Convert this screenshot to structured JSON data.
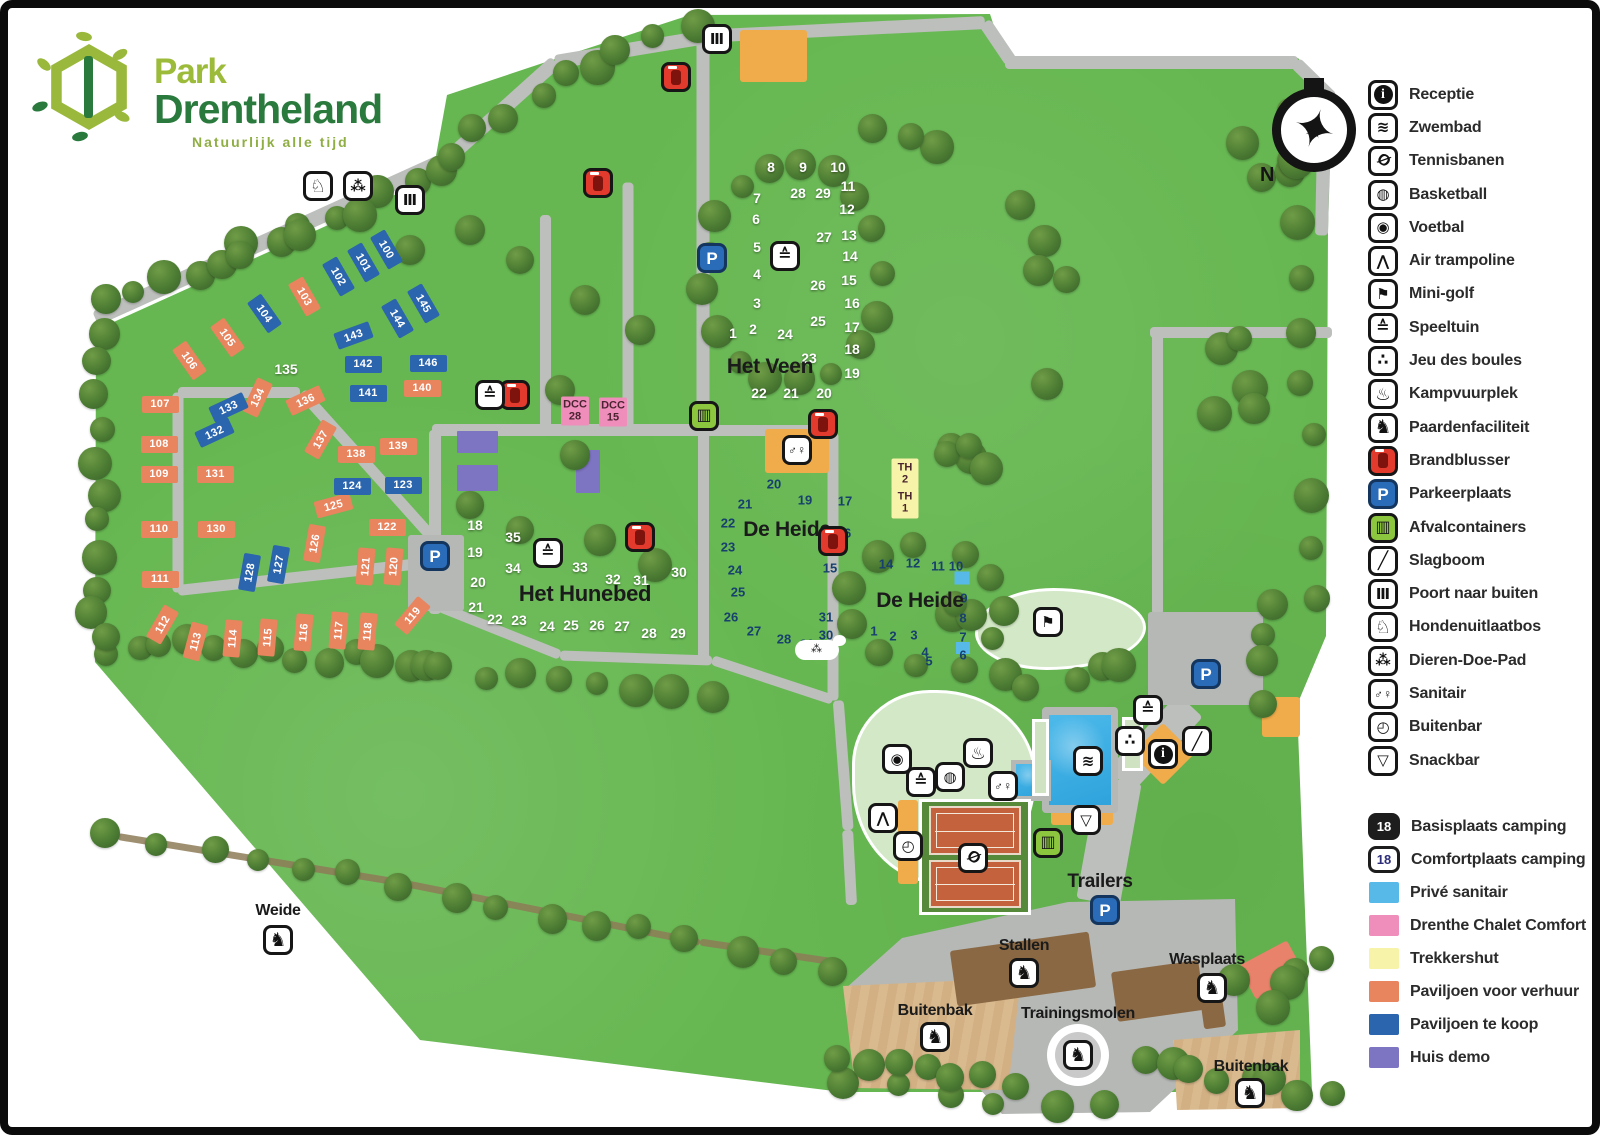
{
  "logo": {
    "line1": "Park",
    "line2": "Drentheland",
    "tagline": "Natuurlijk alle tijd"
  },
  "compass": {
    "north_label": "N"
  },
  "legend": {
    "facilities": [
      {
        "icon": "receptie",
        "label": "Receptie"
      },
      {
        "icon": "zwembad",
        "label": "Zwembad"
      },
      {
        "icon": "tennisbanen",
        "label": "Tennisbanen"
      },
      {
        "icon": "basketball",
        "label": "Basketball"
      },
      {
        "icon": "voetbal",
        "label": "Voetbal"
      },
      {
        "icon": "airtramp",
        "label": "Air trampoline"
      },
      {
        "icon": "minigolf",
        "label": "Mini-golf"
      },
      {
        "icon": "speeltuin",
        "label": "Speeltuin"
      },
      {
        "icon": "boules",
        "label": "Jeu des boules"
      },
      {
        "icon": "kampvuur",
        "label": "Kampvuurplek"
      },
      {
        "icon": "paard",
        "label": "Paardenfaciliteit"
      },
      {
        "icon": "fire",
        "label": "Brandblusser"
      },
      {
        "icon": "parking",
        "label": "Parkeerplaats"
      },
      {
        "icon": "trash",
        "label": "Afvalcontainers"
      },
      {
        "icon": "slagboom",
        "label": "Slagboom"
      },
      {
        "icon": "poort",
        "label": "Poort naar buiten"
      },
      {
        "icon": "hond",
        "label": "Hondenuitlaatbos"
      },
      {
        "icon": "paw",
        "label": "Dieren-Doe-Pad"
      },
      {
        "icon": "sanitair",
        "label": "Sanitair"
      },
      {
        "icon": "buitenbar",
        "label": "Buitenbar"
      },
      {
        "icon": "snackbar",
        "label": "Snackbar"
      }
    ],
    "categories": [
      {
        "type": "badge-dark",
        "badge": "18",
        "label": "Basisplaats camping"
      },
      {
        "type": "badge-outline",
        "badge": "18",
        "label": "Comfortplaats camping"
      },
      {
        "type": "swatch",
        "color": "#56b9e8",
        "label": "Privé sanitair"
      },
      {
        "type": "swatch",
        "color": "#ef8dbb",
        "label": "Drenthe Chalet Comfort"
      },
      {
        "type": "swatch",
        "color": "#f7f3a8",
        "label": "Trekkershut"
      },
      {
        "type": "swatch",
        "color": "#e8845e",
        "label": "Paviljoen voor verhuur"
      },
      {
        "type": "swatch",
        "color": "#2b65ad",
        "label": "Paviljoen te koop"
      },
      {
        "type": "swatch",
        "color": "#7d74c2",
        "label": "Huis demo"
      }
    ]
  },
  "map": {
    "area_labels": [
      {
        "text": "Het Veen",
        "x": 770,
        "y": 367,
        "size": 21
      },
      {
        "text": "Het Hunebed",
        "x": 585,
        "y": 594,
        "size": 22
      },
      {
        "text": "De Heide",
        "x": 787,
        "y": 530,
        "size": 21
      },
      {
        "text": "De Heide",
        "x": 920,
        "y": 601,
        "size": 21
      },
      {
        "text": "Weide",
        "x": 278,
        "y": 911,
        "size": 16
      },
      {
        "text": "Trailers",
        "x": 1100,
        "y": 882,
        "size": 19
      },
      {
        "text": "Stallen",
        "x": 1024,
        "y": 946,
        "size": 16
      },
      {
        "text": "Wasplaats",
        "x": 1207,
        "y": 960,
        "size": 16
      },
      {
        "text": "Trainingsmolen",
        "x": 1078,
        "y": 1014,
        "size": 16
      },
      {
        "text": "Buitenbak",
        "x": 935,
        "y": 1011,
        "size": 16
      },
      {
        "text": "Buitenbak",
        "x": 1251,
        "y": 1067,
        "size": 16
      }
    ],
    "plots_rent": [
      {
        "n": "103",
        "x": 304,
        "y": 296,
        "r": 60
      },
      {
        "n": "105",
        "x": 227,
        "y": 337,
        "r": 55
      },
      {
        "n": "106",
        "x": 189,
        "y": 360,
        "r": 55
      },
      {
        "n": "107",
        "x": 160,
        "y": 404,
        "r": 0
      },
      {
        "n": "108",
        "x": 159,
        "y": 444,
        "r": 0
      },
      {
        "n": "109",
        "x": 159,
        "y": 474,
        "r": 0
      },
      {
        "n": "110",
        "x": 159,
        "y": 529,
        "r": 0
      },
      {
        "n": "111",
        "x": 160,
        "y": 579,
        "r": 0
      },
      {
        "n": "112",
        "x": 162,
        "y": 624,
        "r": -60
      },
      {
        "n": "113",
        "x": 195,
        "y": 641,
        "r": -75
      },
      {
        "n": "114",
        "x": 232,
        "y": 638,
        "r": -85
      },
      {
        "n": "115",
        "x": 267,
        "y": 637,
        "r": -85
      },
      {
        "n": "116",
        "x": 303,
        "y": 632,
        "r": -85
      },
      {
        "n": "117",
        "x": 338,
        "y": 630,
        "r": -85
      },
      {
        "n": "118",
        "x": 367,
        "y": 631,
        "r": -85
      },
      {
        "n": "119",
        "x": 412,
        "y": 615,
        "r": -50
      },
      {
        "n": "120",
        "x": 393,
        "y": 566,
        "r": -85
      },
      {
        "n": "121",
        "x": 365,
        "y": 566,
        "r": -85
      },
      {
        "n": "122",
        "x": 387,
        "y": 527,
        "r": 0
      },
      {
        "n": "125",
        "x": 333,
        "y": 505,
        "r": -15
      },
      {
        "n": "126",
        "x": 314,
        "y": 543,
        "r": -80
      },
      {
        "n": "130",
        "x": 216,
        "y": 529,
        "r": 0
      },
      {
        "n": "131",
        "x": 215,
        "y": 474,
        "r": 0
      },
      {
        "n": "134",
        "x": 257,
        "y": 397,
        "r": -65
      },
      {
        "n": "136",
        "x": 305,
        "y": 400,
        "r": -25
      },
      {
        "n": "137",
        "x": 320,
        "y": 439,
        "r": -60
      },
      {
        "n": "138",
        "x": 356,
        "y": 454,
        "r": 0
      },
      {
        "n": "139",
        "x": 398,
        "y": 446,
        "r": 0
      },
      {
        "n": "140",
        "x": 422,
        "y": 388,
        "r": 0
      }
    ],
    "plots_sale": [
      {
        "n": "100",
        "x": 386,
        "y": 249,
        "r": 60
      },
      {
        "n": "101",
        "x": 363,
        "y": 262,
        "r": 60
      },
      {
        "n": "102",
        "x": 338,
        "y": 276,
        "r": 60
      },
      {
        "n": "104",
        "x": 264,
        "y": 313,
        "r": 55
      },
      {
        "n": "123",
        "x": 403,
        "y": 485,
        "r": 0
      },
      {
        "n": "124",
        "x": 352,
        "y": 486,
        "r": 0
      },
      {
        "n": "127",
        "x": 278,
        "y": 564,
        "r": -80
      },
      {
        "n": "128",
        "x": 249,
        "y": 572,
        "r": -80
      },
      {
        "n": "132",
        "x": 214,
        "y": 432,
        "r": -25
      },
      {
        "n": "133",
        "x": 228,
        "y": 407,
        "r": -25
      },
      {
        "n": "141",
        "x": 368,
        "y": 393,
        "r": 0
      },
      {
        "n": "142",
        "x": 363,
        "y": 364,
        "r": 0
      },
      {
        "n": "143",
        "x": 353,
        "y": 335,
        "r": -20
      },
      {
        "n": "144",
        "x": 397,
        "y": 318,
        "r": 60
      },
      {
        "n": "145",
        "x": 423,
        "y": 303,
        "r": 60
      },
      {
        "n": "146",
        "x": 428,
        "y": 363,
        "r": 0
      }
    ],
    "camp_white": [
      {
        "n": "1",
        "x": 733,
        "y": 333
      },
      {
        "n": "2",
        "x": 753,
        "y": 329
      },
      {
        "n": "3",
        "x": 757,
        "y": 303
      },
      {
        "n": "4",
        "x": 757,
        "y": 274
      },
      {
        "n": "5",
        "x": 757,
        "y": 247
      },
      {
        "n": "6",
        "x": 756,
        "y": 219
      },
      {
        "n": "7",
        "x": 757,
        "y": 198
      },
      {
        "n": "8",
        "x": 771,
        "y": 167
      },
      {
        "n": "9",
        "x": 803,
        "y": 167
      },
      {
        "n": "10",
        "x": 838,
        "y": 167
      },
      {
        "n": "11",
        "x": 848,
        "y": 186
      },
      {
        "n": "12",
        "x": 847,
        "y": 209
      },
      {
        "n": "13",
        "x": 849,
        "y": 235
      },
      {
        "n": "14",
        "x": 850,
        "y": 256
      },
      {
        "n": "15",
        "x": 849,
        "y": 280
      },
      {
        "n": "16",
        "x": 852,
        "y": 303
      },
      {
        "n": "17",
        "x": 852,
        "y": 327
      },
      {
        "n": "18",
        "x": 852,
        "y": 349
      },
      {
        "n": "19",
        "x": 852,
        "y": 373
      },
      {
        "n": "20",
        "x": 824,
        "y": 393
      },
      {
        "n": "21",
        "x": 791,
        "y": 393
      },
      {
        "n": "22",
        "x": 759,
        "y": 393
      },
      {
        "n": "23",
        "x": 809,
        "y": 358
      },
      {
        "n": "24",
        "x": 785,
        "y": 334
      },
      {
        "n": "25",
        "x": 818,
        "y": 321
      },
      {
        "n": "26",
        "x": 818,
        "y": 285
      },
      {
        "n": "27",
        "x": 824,
        "y": 237
      },
      {
        "n": "28",
        "x": 798,
        "y": 193
      },
      {
        "n": "29",
        "x": 823,
        "y": 193
      },
      {
        "n": "18",
        "x": 475,
        "y": 525
      },
      {
        "n": "19",
        "x": 475,
        "y": 552
      },
      {
        "n": "20",
        "x": 478,
        "y": 582
      },
      {
        "n": "21",
        "x": 476,
        "y": 607
      },
      {
        "n": "22",
        "x": 495,
        "y": 619
      },
      {
        "n": "23",
        "x": 519,
        "y": 620
      },
      {
        "n": "24",
        "x": 547,
        "y": 626
      },
      {
        "n": "25",
        "x": 571,
        "y": 625
      },
      {
        "n": "26",
        "x": 597,
        "y": 625
      },
      {
        "n": "27",
        "x": 622,
        "y": 626
      },
      {
        "n": "28",
        "x": 649,
        "y": 633
      },
      {
        "n": "29",
        "x": 678,
        "y": 633
      },
      {
        "n": "30",
        "x": 679,
        "y": 572
      },
      {
        "n": "31",
        "x": 641,
        "y": 580
      },
      {
        "n": "32",
        "x": 613,
        "y": 579
      },
      {
        "n": "33",
        "x": 580,
        "y": 567
      },
      {
        "n": "34",
        "x": 513,
        "y": 568
      },
      {
        "n": "35",
        "x": 513,
        "y": 537
      },
      {
        "n": "135",
        "x": 286,
        "y": 369
      }
    ],
    "camp_dark": [
      {
        "n": "15",
        "x": 830,
        "y": 568
      },
      {
        "n": "16",
        "x": 844,
        "y": 533
      },
      {
        "n": "17",
        "x": 845,
        "y": 501
      },
      {
        "n": "19",
        "x": 805,
        "y": 500
      },
      {
        "n": "20",
        "x": 774,
        "y": 484
      },
      {
        "n": "21",
        "x": 745,
        "y": 504
      },
      {
        "n": "22",
        "x": 728,
        "y": 523
      },
      {
        "n": "23",
        "x": 728,
        "y": 547
      },
      {
        "n": "24",
        "x": 735,
        "y": 570
      },
      {
        "n": "25",
        "x": 738,
        "y": 592
      },
      {
        "n": "26",
        "x": 731,
        "y": 617
      },
      {
        "n": "27",
        "x": 754,
        "y": 631
      },
      {
        "n": "28",
        "x": 784,
        "y": 639
      },
      {
        "n": "29",
        "x": 807,
        "y": 644
      },
      {
        "n": "30",
        "x": 826,
        "y": 635
      },
      {
        "n": "31",
        "x": 826,
        "y": 617
      },
      {
        "n": "1",
        "x": 874,
        "y": 631
      },
      {
        "n": "2",
        "x": 893,
        "y": 636
      },
      {
        "n": "3",
        "x": 914,
        "y": 635
      },
      {
        "n": "4",
        "x": 925,
        "y": 652
      },
      {
        "n": "5",
        "x": 929,
        "y": 661
      },
      {
        "n": "6",
        "x": 963,
        "y": 655
      },
      {
        "n": "7",
        "x": 963,
        "y": 637
      },
      {
        "n": "8",
        "x": 963,
        "y": 618
      },
      {
        "n": "9",
        "x": 964,
        "y": 598
      },
      {
        "n": "10",
        "x": 956,
        "y": 566
      },
      {
        "n": "11",
        "x": 938,
        "y": 566
      },
      {
        "n": "12",
        "x": 913,
        "y": 563
      },
      {
        "n": "14",
        "x": 886,
        "y": 564
      }
    ],
    "special_boxes": [
      {
        "lines": [
          "DCC",
          "28"
        ],
        "color": "#ef8dbb",
        "x": 575,
        "y": 411,
        "w": 28,
        "h": 29
      },
      {
        "lines": [
          "DCC",
          "15"
        ],
        "color": "#ef8dbb",
        "x": 613,
        "y": 412,
        "w": 28,
        "h": 29
      },
      {
        "lines": [
          "TH",
          "2"
        ],
        "color": "#f7f3a8",
        "x": 905,
        "y": 474,
        "w": 27,
        "h": 31
      },
      {
        "lines": [
          "TH",
          "1"
        ],
        "color": "#f7f3a8",
        "x": 905,
        "y": 503,
        "w": 27,
        "h": 31
      }
    ],
    "prive_sanitair_squares": [
      {
        "x": 962,
        "y": 578,
        "w": 15,
        "h": 13
      },
      {
        "x": 963,
        "y": 648,
        "w": 14,
        "h": 12
      }
    ],
    "icons": [
      {
        "t": "poort",
        "x": 717,
        "y": 39
      },
      {
        "t": "poort",
        "x": 410,
        "y": 200
      },
      {
        "t": "hond",
        "x": 318,
        "y": 186
      },
      {
        "t": "paw",
        "x": 358,
        "y": 186
      },
      {
        "t": "fire",
        "x": 676,
        "y": 77
      },
      {
        "t": "fire",
        "x": 598,
        "y": 183
      },
      {
        "t": "fire",
        "x": 515,
        "y": 395
      },
      {
        "t": "fire",
        "x": 823,
        "y": 424
      },
      {
        "t": "fire",
        "x": 640,
        "y": 537
      },
      {
        "t": "fire",
        "x": 833,
        "y": 541
      },
      {
        "t": "parking",
        "x": 712,
        "y": 258
      },
      {
        "t": "parking",
        "x": 435,
        "y": 556
      },
      {
        "t": "parking",
        "x": 1105,
        "y": 910
      },
      {
        "t": "parking",
        "x": 1206,
        "y": 674
      },
      {
        "t": "trash",
        "x": 704,
        "y": 416
      },
      {
        "t": "trash",
        "x": 1048,
        "y": 843
      },
      {
        "t": "speeltuin",
        "x": 490,
        "y": 395
      },
      {
        "t": "speeltuin",
        "x": 548,
        "y": 553
      },
      {
        "t": "speeltuin",
        "x": 785,
        "y": 256
      },
      {
        "t": "speeltuin",
        "x": 1148,
        "y": 710
      },
      {
        "t": "speeltuin",
        "x": 921,
        "y": 782
      },
      {
        "t": "kampvuur",
        "x": 978,
        "y": 753
      },
      {
        "t": "voetbal",
        "x": 897,
        "y": 759
      },
      {
        "t": "basketball",
        "x": 950,
        "y": 777
      },
      {
        "t": "airtramp",
        "x": 883,
        "y": 818
      },
      {
        "t": "buitenbar",
        "x": 908,
        "y": 846
      },
      {
        "t": "zwembad",
        "x": 1088,
        "y": 761
      },
      {
        "t": "snackbar",
        "x": 1086,
        "y": 820
      },
      {
        "t": "tennisbanen",
        "x": 973,
        "y": 858
      },
      {
        "t": "minigolf",
        "x": 1048,
        "y": 622
      },
      {
        "t": "boules",
        "x": 1130,
        "y": 741
      },
      {
        "t": "slagboom",
        "x": 1197,
        "y": 741
      },
      {
        "t": "receptie",
        "x": 1163,
        "y": 754
      },
      {
        "t": "sanitair",
        "x": 797,
        "y": 450
      },
      {
        "t": "sanitair",
        "x": 1003,
        "y": 786
      },
      {
        "t": "paard",
        "x": 278,
        "y": 940
      },
      {
        "t": "paard",
        "x": 1024,
        "y": 973
      },
      {
        "t": "paard",
        "x": 1212,
        "y": 988
      },
      {
        "t": "paard",
        "x": 935,
        "y": 1037
      },
      {
        "t": "paard",
        "x": 1250,
        "y": 1093
      },
      {
        "t": "paard",
        "x": 1078,
        "y": 1055
      }
    ]
  }
}
